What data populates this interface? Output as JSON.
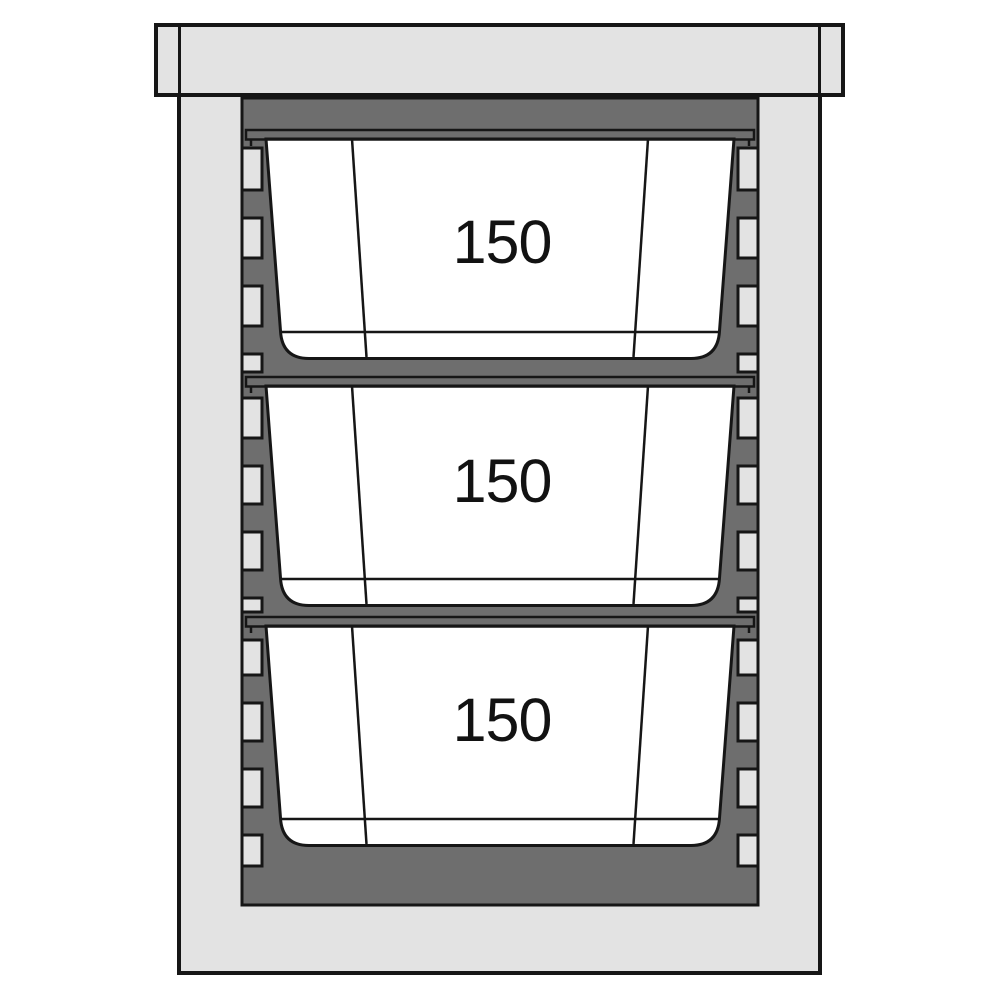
{
  "diagram": {
    "name": "insulated-gn-carrier-cross-section",
    "containers": [
      {
        "label": "150"
      },
      {
        "label": "150"
      },
      {
        "label": "150"
      }
    ]
  },
  "colors": {
    "background": "#ffffff",
    "housing": "#e3e3e3",
    "liner": "#6e6e6e",
    "pan": "#ffffff",
    "outline": "#161616"
  }
}
